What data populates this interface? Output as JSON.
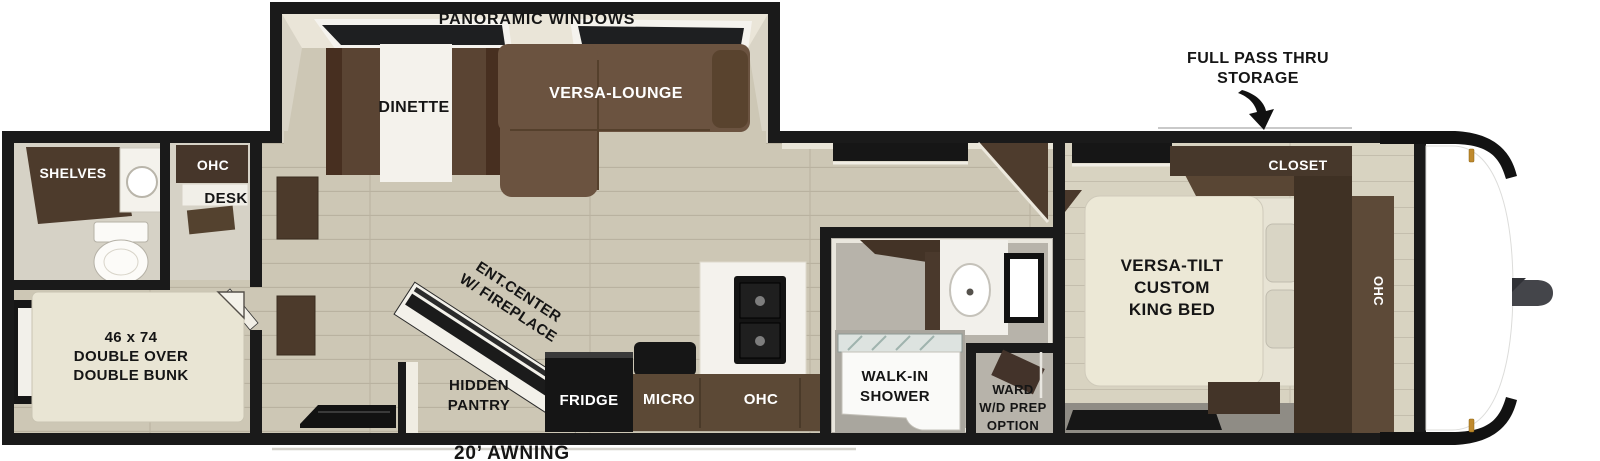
{
  "palette": {
    "wall": "#1a1a1a",
    "floor_wood": "#cdc7b5",
    "floor_wood_light": "#d8d3c1",
    "floor_gray": "#b5b2ab",
    "cabinet_dark": "#4a3929",
    "cabinet_mid": "#5d4936",
    "sofa_brown": "#6b5340",
    "bed_cream": "#ebe7d6",
    "front_cap": "#ffffff",
    "marker_light_gold": "#c08a2e"
  },
  "exterior": {
    "pass_thru_storage_lines": [
      "FULL PASS THRU",
      "STORAGE"
    ],
    "awning_label": "20’ AWNING"
  },
  "slideout": {
    "windows_label": "PANORAMIC WINDOWS",
    "dinette_label": "DINETTE",
    "lounge_label": "VERSA-LOUNGE"
  },
  "rear_bath": {
    "shelves_label": "SHELVES"
  },
  "desk_area": {
    "ohc_label": "OHC",
    "desk_label": "DESK"
  },
  "bunk_room": {
    "bunk_label_lines": [
      "46 x 74",
      "DOUBLE OVER",
      "DOUBLE BUNK"
    ]
  },
  "living_area": {
    "ent_center_lines": [
      "ENT.CENTER",
      "W/ FIREPLACE"
    ],
    "hidden_pantry_lines": [
      "HIDDEN",
      "PANTRY"
    ]
  },
  "kitchen": {
    "fridge_label": "FRIDGE",
    "micro_label": "MICRO",
    "ohc_label": "OHC"
  },
  "bathroom": {
    "shower_lines": [
      "WALK-IN",
      "SHOWER"
    ]
  },
  "ward_room": {
    "label_lines": [
      "WARD",
      "W/D PREP",
      "OPTION"
    ]
  },
  "bedroom": {
    "bed_label_lines": [
      "VERSA-TILT",
      "CUSTOM",
      "KING BED"
    ],
    "closet_label": "CLOSET",
    "ohc_label": "OHC"
  }
}
